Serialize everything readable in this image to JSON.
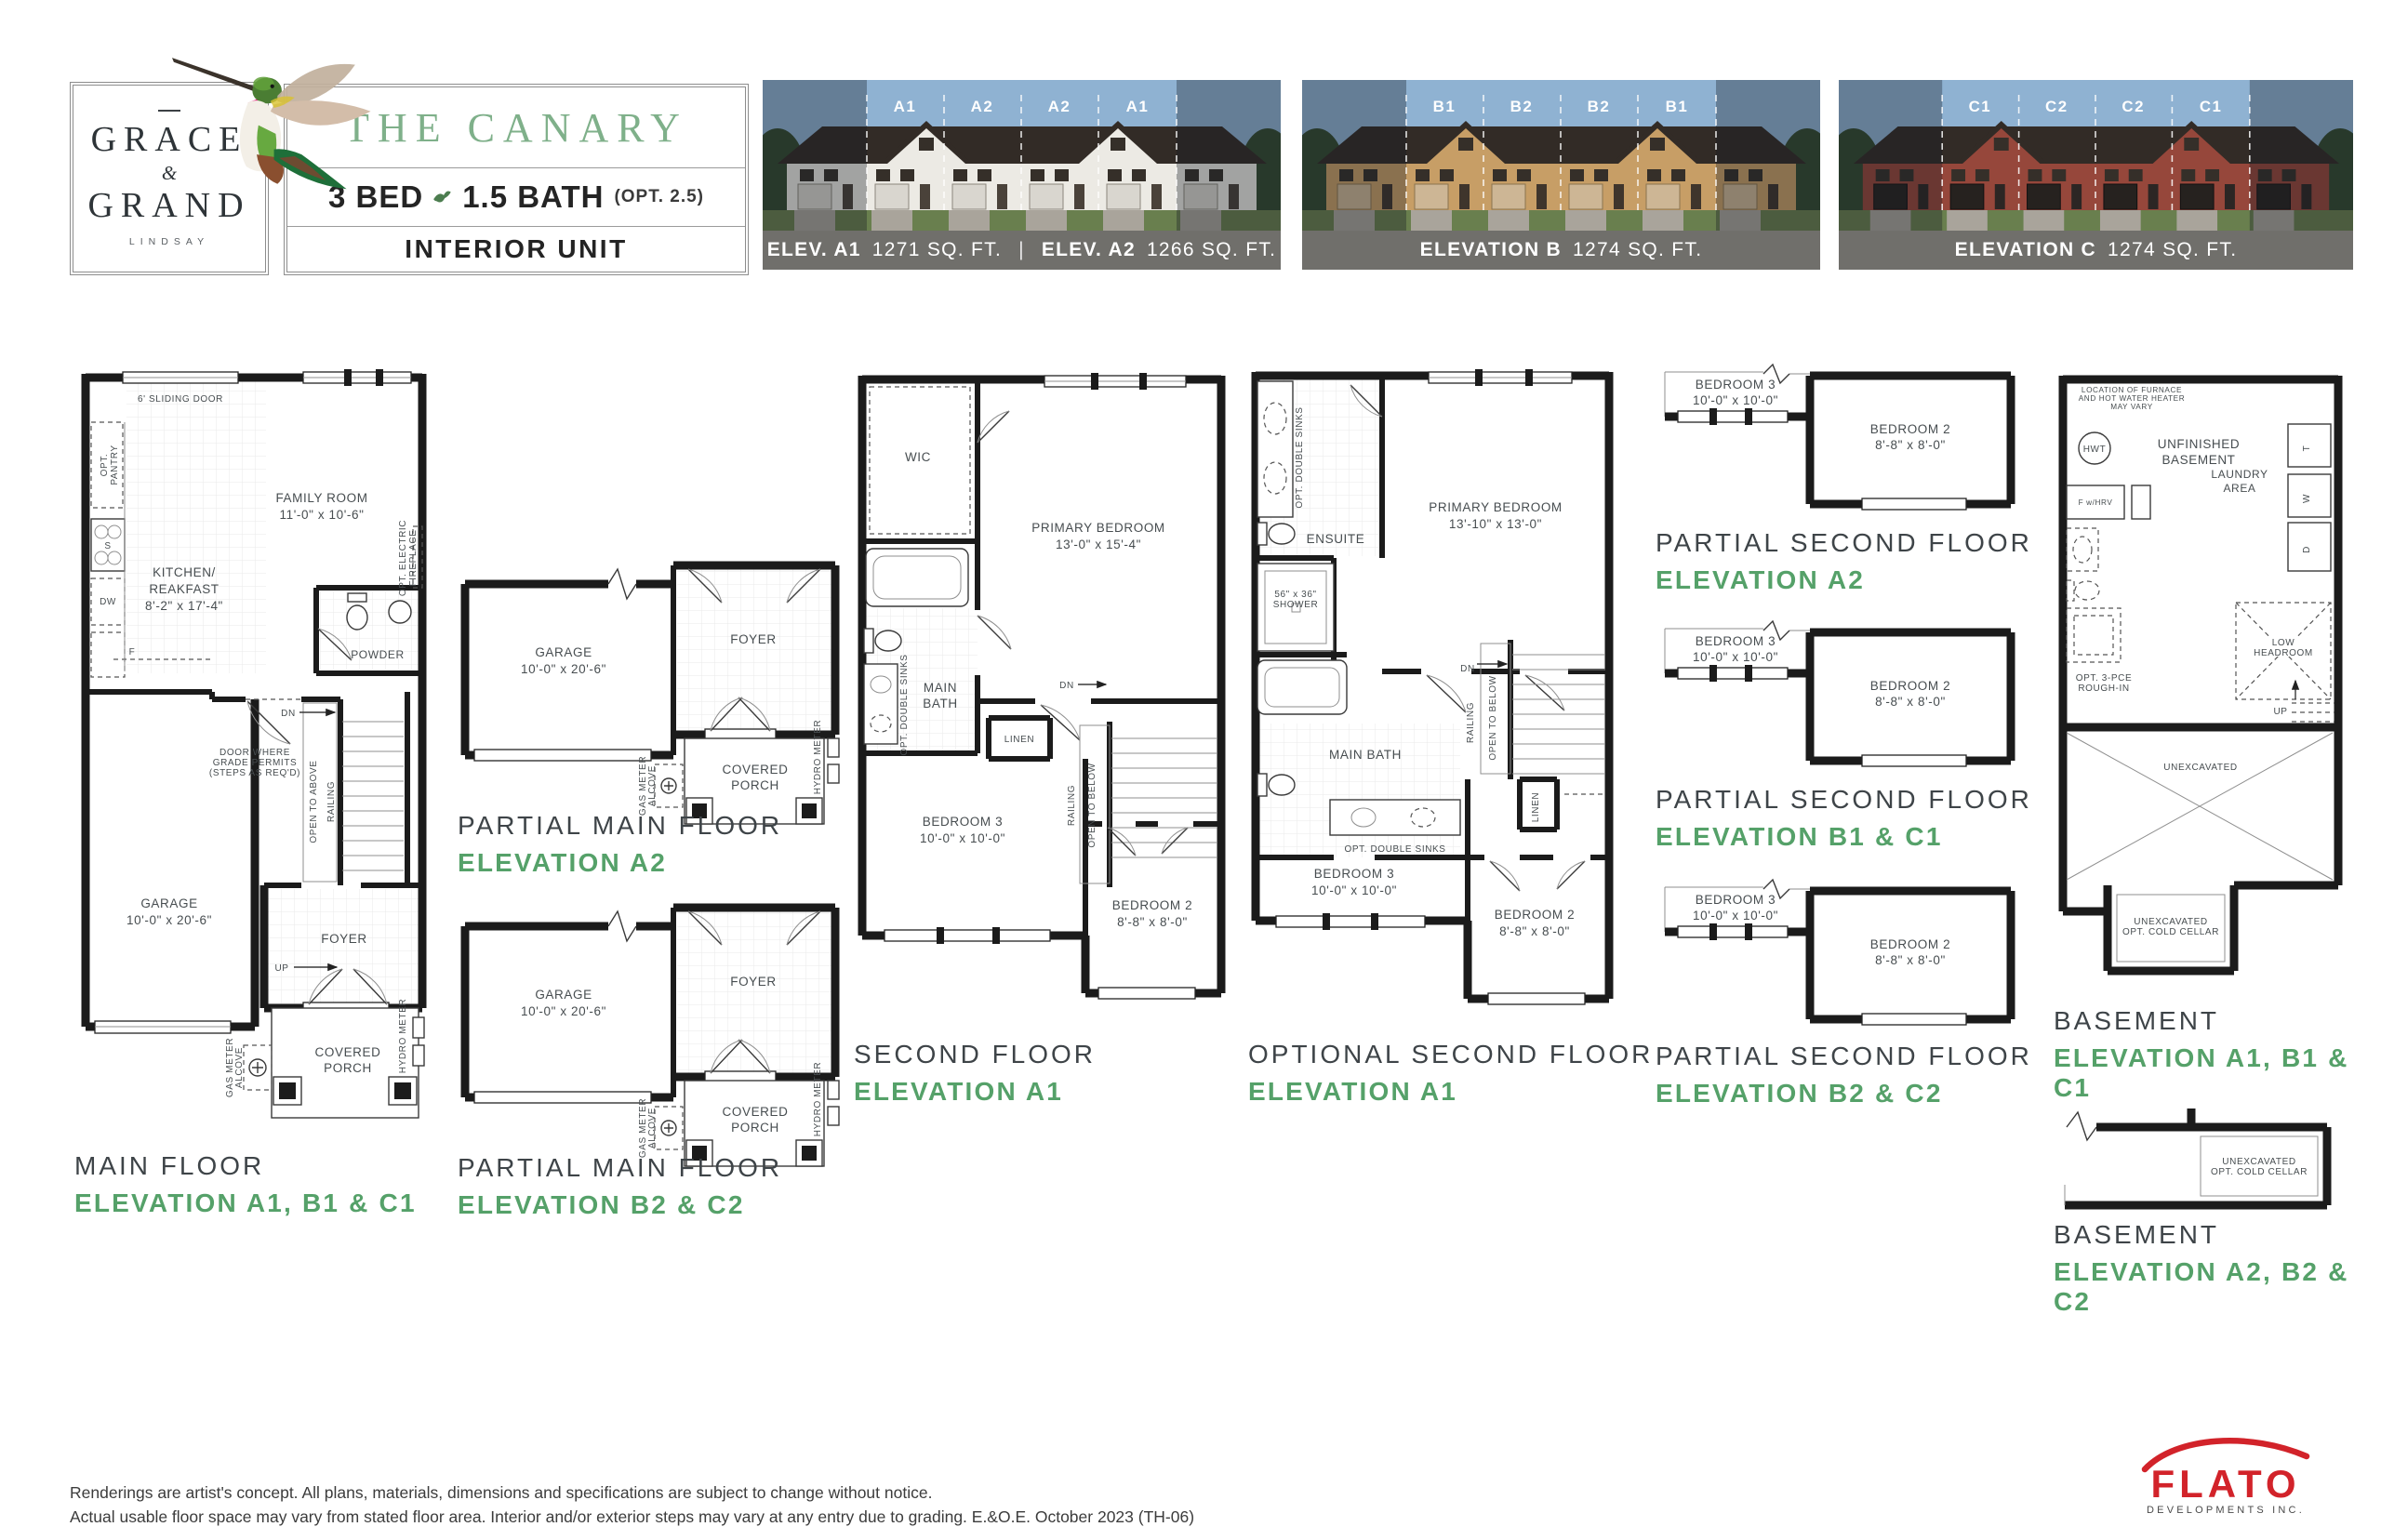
{
  "colors": {
    "accent-green": "#55a169",
    "title-green": "#7fb08a",
    "caption-bar": "#706f6b",
    "flato-red": "#d2232a",
    "sky": "#8fb2d2",
    "lawn": "#697f4e",
    "tree": "#33492f",
    "roof": "#322b26",
    "facade-a": "#eceae4",
    "facade-b": "#c79e66",
    "facade-c": "#96473b"
  },
  "header": {
    "logo": {
      "accent": "—",
      "word1": "GRACE",
      "amp": "&",
      "word2": "GRAND",
      "city": "LINDSAY"
    },
    "title": {
      "name": "THE CANARY",
      "bed": "3 BED",
      "bath": "1.5 BATH",
      "opt": "(OPT. 2.5)",
      "unit": "INTERIOR UNIT"
    },
    "elev_a": {
      "units": [
        "A1",
        "A2",
        "A2",
        "A1"
      ],
      "cap_l1": "ELEV. A1",
      "cap_a1": "1271 SQ. FT.",
      "sep": "|",
      "cap_l2": "ELEV. A2",
      "cap_a2": "1266 SQ. FT."
    },
    "elev_b": {
      "units": [
        "B1",
        "B2",
        "B2",
        "B1"
      ],
      "cap": "ELEVATION B",
      "area": "1274 SQ. FT."
    },
    "elev_c": {
      "units": [
        "C1",
        "C2",
        "C2",
        "C1"
      ],
      "cap": "ELEVATION C",
      "area": "1274 SQ. FT."
    }
  },
  "plans": {
    "main_floor": {
      "title": "MAIN FLOOR",
      "subtitle": "ELEVATION A1, B1 & C1",
      "labels": {
        "sliding_door": "6' SLIDING DOOR",
        "opt_pantry": "OPT.\nPANTRY",
        "family_room": "FAMILY ROOM\n11'-0\" x 10'-6\"",
        "kitchen": "KITCHEN/\nREAKFAST\n8'-2\" x 17'-4\"",
        "fireplace": "OPT. ELECTRIC\nFIREPLACE",
        "powder": "POWDER",
        "dn": "DN",
        "grade_door": "DOOR WHERE\nGRADE PERMITS\n(STEPS AS REQ'D)",
        "open_above": "OPEN TO ABOVE",
        "railing": "RAILING",
        "garage": "GARAGE\n10'-0\" x 20'-6\"",
        "up": "UP",
        "foyer": "FOYER",
        "porch": "COVERED\nPORCH",
        "gas": "GAS METER\nALCOVE",
        "hydro": "HYDRO METER",
        "s": "S",
        "dw": "DW",
        "f": "F"
      }
    },
    "partial_main": {
      "labels": {
        "garage": "GARAGE\n10'-0\" x 20'-6\"",
        "foyer": "FOYER",
        "porch": "COVERED\nPORCH",
        "gas": "GAS METER\nALCOVE",
        "hydro": "HYDRO METER"
      }
    },
    "partial_main_a2": {
      "title": "PARTIAL MAIN FLOOR",
      "subtitle": "ELEVATION A2"
    },
    "partial_main_b2c2": {
      "title": "PARTIAL MAIN FLOOR",
      "subtitle": "ELEVATION B2 & C2"
    },
    "second_floor": {
      "title": "SECOND FLOOR",
      "subtitle": "ELEVATION A1",
      "labels": {
        "wic": "WIC",
        "primary": "PRIMARY BEDROOM\n13'-0\" x 15'-4\"",
        "opt_sinks": "OPT. DOUBLE SINKS",
        "main_bath": "MAIN\nBATH",
        "linen": "LINEN",
        "dn": "DN",
        "railing": "RAILING",
        "open_below": "OPEN TO BELOW",
        "bed3": "BEDROOM 3\n10'-0\" x 10'-0\"",
        "bed2": "BEDROOM 2\n8'-8\" x 8'-0\""
      }
    },
    "optional_second": {
      "title": "OPTIONAL SECOND FLOOR",
      "subtitle": "ELEVATION A1",
      "labels": {
        "opt_sinks": "OPT. DOUBLE SINKS",
        "ensuite": "ENSUITE",
        "shower": "56\" x 36\"\nSHOWER",
        "primary": "PRIMARY BEDROOM\n13'-10\" x 13'-0\"",
        "main_bath": "MAIN BATH",
        "opt_sinks2": "OPT. DOUBLE SINKS",
        "dn": "DN",
        "railing": "RAILING",
        "open_below": "OPEN TO BELOW",
        "linen": "LINEN",
        "bed3": "BEDROOM 3\n10'-0\" x 10'-0\"",
        "bed2": "BEDROOM 2\n8'-8\" x 8'-0\""
      }
    },
    "partial_second": {
      "labels": {
        "bed3": "BEDROOM 3\n10'-0\" x 10'-0\"",
        "bed2": "BEDROOM 2\n8'-8\" x 8'-0\""
      }
    },
    "partial_second_a2": {
      "title": "PARTIAL SECOND FLOOR",
      "subtitle": "ELEVATION A2"
    },
    "partial_second_b1c1": {
      "title": "PARTIAL SECOND FLOOR",
      "subtitle": "ELEVATION B1 & C1"
    },
    "partial_second_b2c2": {
      "title": "PARTIAL SECOND FLOOR",
      "subtitle": "ELEVATION B2 & C2"
    },
    "basement1": {
      "title": "BASEMENT",
      "subtitle": "ELEVATION A1, B1 & C1",
      "labels": {
        "note": "LOCATION OF FURNACE\nAND HOT WATER HEATER\nMAY VARY",
        "hwt": "HWT",
        "unfinished": "UNFINISHED\nBASEMENT",
        "fhrv": "F w/HRV",
        "laundry": "LAUNDRY\nAREA",
        "t": "T",
        "w": "W",
        "d": "D",
        "rough": "OPT. 3-PCE\nROUGH-IN",
        "low": "LOW\nHEADROOM",
        "up": "UP",
        "unex": "UNEXCAVATED",
        "cold": "UNEXCAVATED\nOPT. COLD CELLAR"
      }
    },
    "basement2": {
      "title": "BASEMENT",
      "subtitle": "ELEVATION A2, B2 & C2",
      "labels": {
        "cold": "UNEXCAVATED\nOPT. COLD CELLAR"
      }
    }
  },
  "footer": {
    "line1": "Renderings are artist's concept. All plans, materials, dimensions and specifications are subject to change without notice.",
    "line2": "Actual usable floor space may vary from stated floor area. Interior and/or exterior steps may vary at any entry due to grading. E.&O.E. October 2023 (TH-06)",
    "flato": "FLATO",
    "flato_sub": "DEVELOPMENTS INC."
  }
}
